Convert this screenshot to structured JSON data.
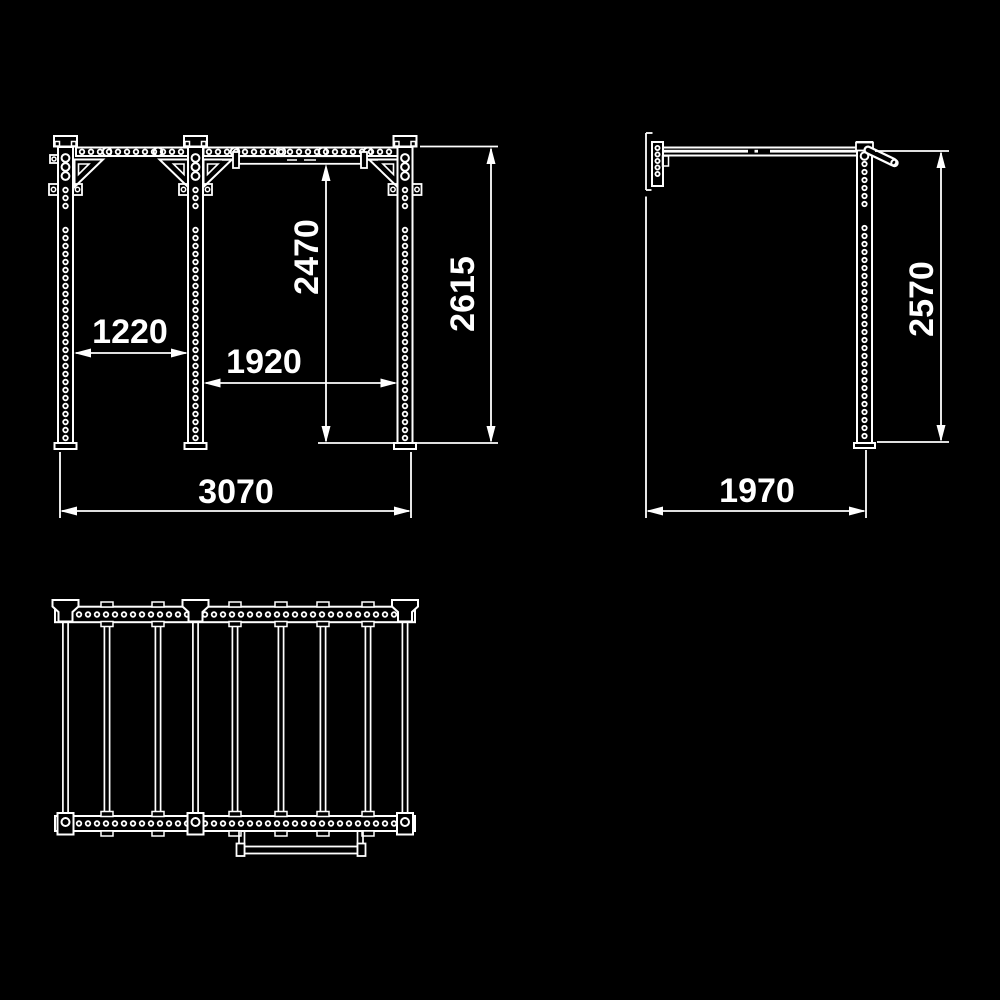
{
  "colors": {
    "background": "#000000",
    "line": "#ffffff"
  },
  "views": {
    "front": {
      "dimensions": {
        "left_bay_width": "1220",
        "right_bay_width": "1920",
        "pullup_bar_height": "2470",
        "overall_height": "2615",
        "overall_width": "3070"
      }
    },
    "side": {
      "dimensions": {
        "overall_height": "2570",
        "overall_depth": "1970"
      }
    }
  }
}
